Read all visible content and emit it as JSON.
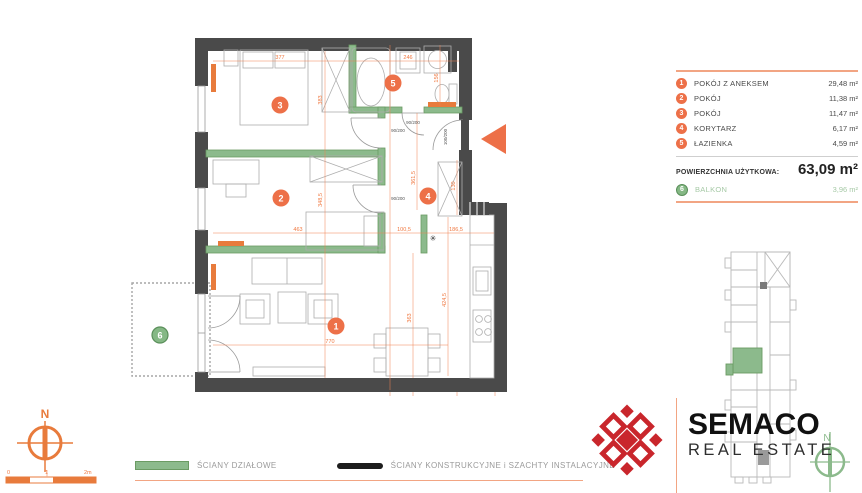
{
  "colors": {
    "accent_orange": "#ED7048",
    "dim_orange": "#F08050",
    "wall_green": "#8CBA8C",
    "wall_dark": "#4A4A4A",
    "logo_red": "#C9262C",
    "balcony_green": "#85B885",
    "rule_orange": "#F2A583"
  },
  "panel": {
    "rooms": [
      {
        "num": "1",
        "name": "POKÓJ Z ANEKSEM",
        "area": "29,48 m²"
      },
      {
        "num": "2",
        "name": "POKÓJ",
        "area": "11,38 m²"
      },
      {
        "num": "3",
        "name": "POKÓJ",
        "area": "11,47 m²"
      },
      {
        "num": "4",
        "name": "KORYTARZ",
        "area": "6,17 m²"
      },
      {
        "num": "5",
        "name": "ŁAZIENKA",
        "area": "4,59 m²"
      }
    ],
    "total_label": "POWIERZCHNIA UŻYTKOWA:",
    "total_value": "63,09 m²",
    "balcony": {
      "num": "6",
      "name": "BALKON",
      "area": "3,96 m²"
    }
  },
  "plan": {
    "badges": {
      "b1": "1",
      "b2": "2",
      "b3": "3",
      "b4": "4",
      "b5": "5",
      "b6": "6"
    },
    "dims": {
      "d377": "377",
      "d246": "246",
      "d383": "383",
      "d3485": "348,5",
      "d156": "156",
      "d463": "463",
      "d1005": "100,5",
      "d1865": "186,5",
      "d3615": "361,5",
      "d130": "130",
      "d770": "770",
      "d363": "363",
      "d4245": "424,5"
    },
    "door_labels": {
      "room3": "90/200",
      "room2": "90/200",
      "bath": "90/200",
      "entry": "100/200"
    },
    "vent_symbol": "✳"
  },
  "legend": {
    "partition_label": "ŚCIANY DZIAŁOWE",
    "structural_label": "ŚCIANY KONSTRUKCYJNE i SZACHTY INSTALACYJNE"
  },
  "compass": {
    "north": "N"
  },
  "scalebar": {
    "zero": "0",
    "one": "1",
    "two": "2m"
  },
  "keyplan": {
    "north": "N"
  },
  "logo": {
    "title": "SEMACO",
    "subtitle": "REAL ESTATE"
  }
}
